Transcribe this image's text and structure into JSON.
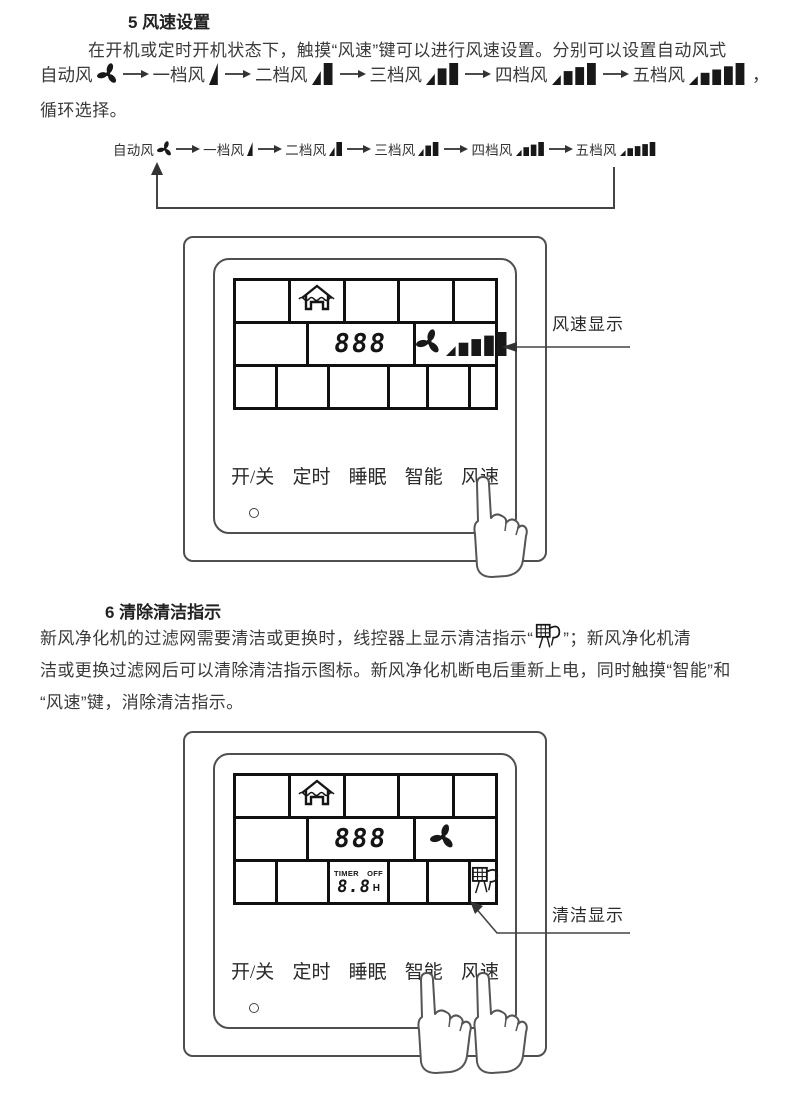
{
  "page": {
    "background": "#ffffff",
    "text_color": "#3a3a3a",
    "accent_dark": "#101010"
  },
  "section5": {
    "title": "5 风速设置",
    "line1": "在开机或定时开机状态下，触摸“风速”键可以进行风速设置。分别可以设置自动风式",
    "line2_trailing": "，",
    "line3": "循环选择。"
  },
  "speed_steps": [
    {
      "label": "自动风",
      "icon": "fan-icon",
      "bars": 0
    },
    {
      "label": "一档风",
      "icon": "speed-bars-1-icon",
      "bars": 1
    },
    {
      "label": "二档风",
      "icon": "speed-bars-2-icon",
      "bars": 2
    },
    {
      "label": "三档风",
      "icon": "speed-bars-3-icon",
      "bars": 3
    },
    {
      "label": "四档风",
      "icon": "speed-bars-4-icon",
      "bars": 4
    },
    {
      "label": "五档风",
      "icon": "speed-bars-5-icon",
      "bars": 5
    }
  ],
  "controller": {
    "display_digits": "888",
    "speed_display_bars": 5,
    "timer": {
      "label": "TIMER",
      "state": "OFF",
      "digits": "8.8",
      "unit": "H"
    },
    "buttons": [
      {
        "label": "开/关"
      },
      {
        "label": "定时"
      },
      {
        "label": "睡眠"
      },
      {
        "label": "智能"
      },
      {
        "label": "风速"
      }
    ]
  },
  "callouts": {
    "speed": "风速显示",
    "clean": "清洁显示"
  },
  "section6": {
    "title": "6 清除清洁指示",
    "line1_pre": "新风净化机的过滤网需要清洁或更换时，线控器上显示清洁指示“",
    "line1_post": "”；新风净化机清",
    "line2": "洁或更换过滤网后可以清除清洁指示图标。新风净化机断电后重新上电，同时触摸“智能”和",
    "line3": "“风速”键，消除清洁指示。"
  }
}
